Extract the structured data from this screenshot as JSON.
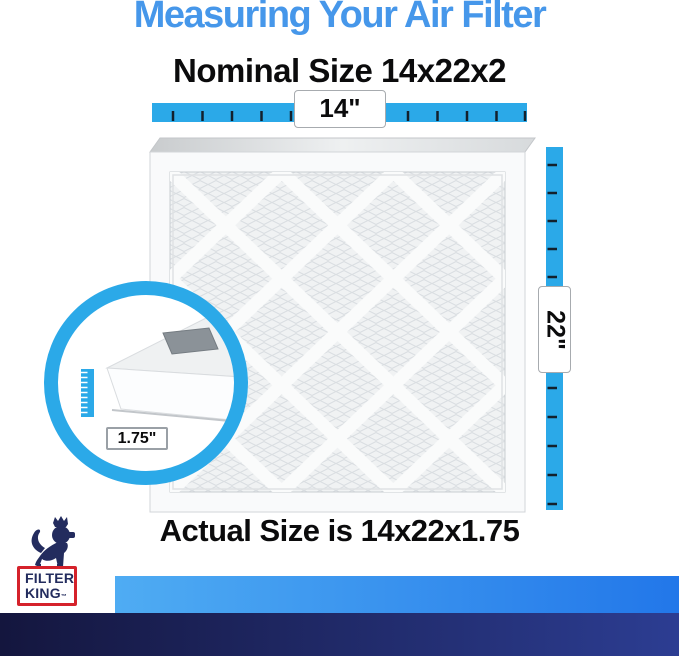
{
  "title": {
    "text": "Measuring Your Air Filter"
  },
  "nominal_size": {
    "text": "Nominal Size 14x22x2"
  },
  "actual_size": {
    "text": "Actual Size is 14x22x1.75"
  },
  "measurements": {
    "width": "14\"",
    "height": "22\"",
    "depth": "1.75\""
  },
  "logo": {
    "line1": "FILTER",
    "line2": "KING",
    "trademark": "™"
  },
  "colors": {
    "accent_blue": "#2BA9E8",
    "title_blue": "#4697EA",
    "logo_navy": "#232C5E",
    "logo_red": "#D5222B",
    "bar_light_start": "#4FACF3",
    "bar_light_end": "#2277E9",
    "bar_dark_start": "#14163E",
    "bar_dark_end": "#2C3D92"
  }
}
